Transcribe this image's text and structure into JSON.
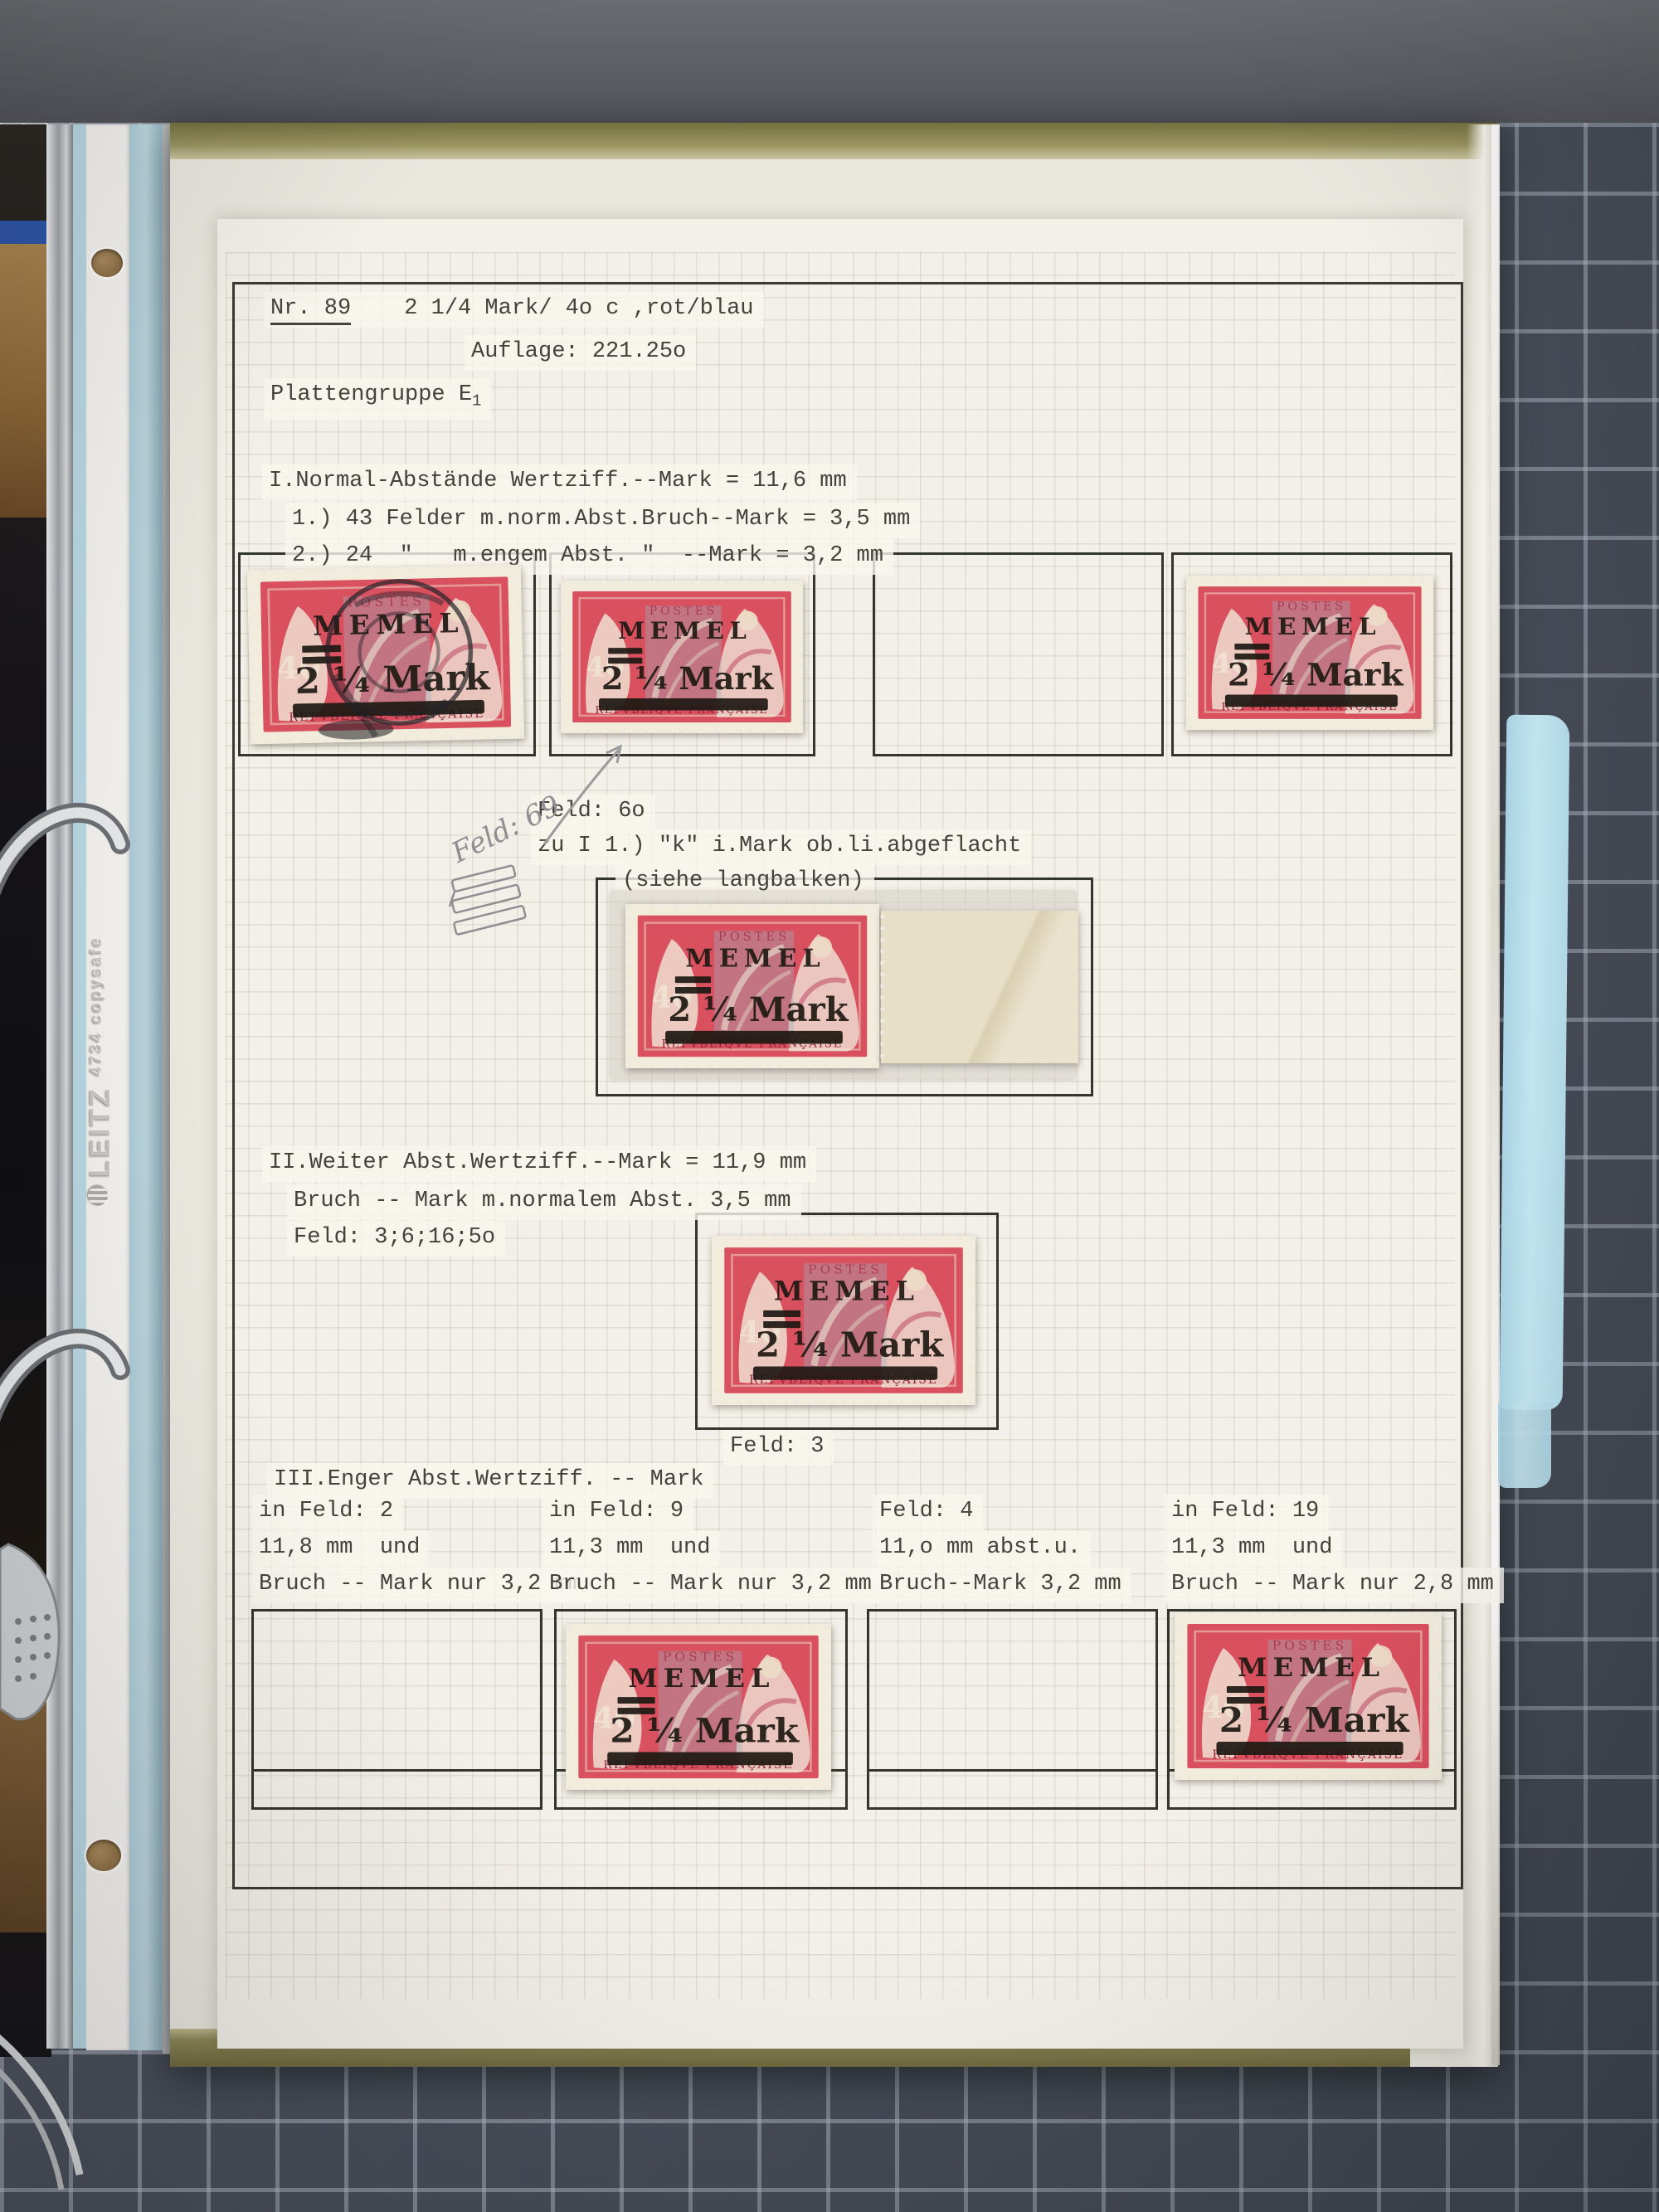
{
  "scene": {
    "desk_color": "#5b5e63",
    "mat_color": "#4b515d",
    "mat_grid_line": "#b9c3cf",
    "tab_color": "#bfe2ee"
  },
  "binder": {
    "brand": "LEITZ",
    "model": "4734",
    "product_line": "copysafe"
  },
  "page": {
    "header": {
      "nr": "Nr. 89",
      "title": "2 1/4 Mark/ 4o c ,rot/blau",
      "auflage": "Auflage: 221.25o",
      "plattengruppe": "Plattengruppe E",
      "plattengruppe_index": "1"
    },
    "section_1": {
      "line1": "I.Normal-Abstände Wertziff.--Mark = 11,6 mm",
      "line2": "1.) 43 Felder m.norm.Abst.Bruch--Mark = 3,5 mm",
      "line3": "2.) 24  \"   m.engem Abst. \"  --Mark = 3,2 mm"
    },
    "note_feld60": {
      "line1": "Feld: 6o",
      "line2": "zu I 1.) \"k\" i.Mark ob.li.abgeflacht",
      "line3": "(siehe langbalken)"
    },
    "handwritten_note": "Feld: 69",
    "section_2": {
      "line1": "II.Weiter Abst.Wertziff.--Mark = 11,9 mm",
      "line2": "Bruch -- Mark m.normalem Abst. 3,5 mm",
      "line3": "Feld: 3;6;16;5o"
    },
    "caption_feld3": "Feld: 3",
    "section_3": {
      "heading": "III.Enger Abst.Wertziff. -- Mark",
      "columns": [
        {
          "line1": "in Feld: 2",
          "line2": "11,8 mm  und",
          "line3": "Bruch -- Mark nur 3,2 mm"
        },
        {
          "line1": "in Feld: 9",
          "line2": "11,3 mm  und",
          "line3": "Bruch -- Mark nur 3,2 mm"
        },
        {
          "line1": "Feld: 4",
          "line2": "11,o mm abst.u.",
          "line3": "Bruch--Mark 3,2 mm"
        },
        {
          "line1": "in Feld: 19",
          "line2": "11,3 mm  und",
          "line3": "Bruch -- Mark nur 2,8 mm"
        }
      ]
    }
  },
  "stamp": {
    "overprint_line1": "MEMEL",
    "overprint_value": "2 ¼ Mark",
    "base_inscription": "REPVBLIQVE FRANÇAISE",
    "base_value": "40",
    "base_top": "POSTES",
    "red": "#d9505f",
    "paper": "#f2ecdc",
    "ink": "#201a14"
  }
}
